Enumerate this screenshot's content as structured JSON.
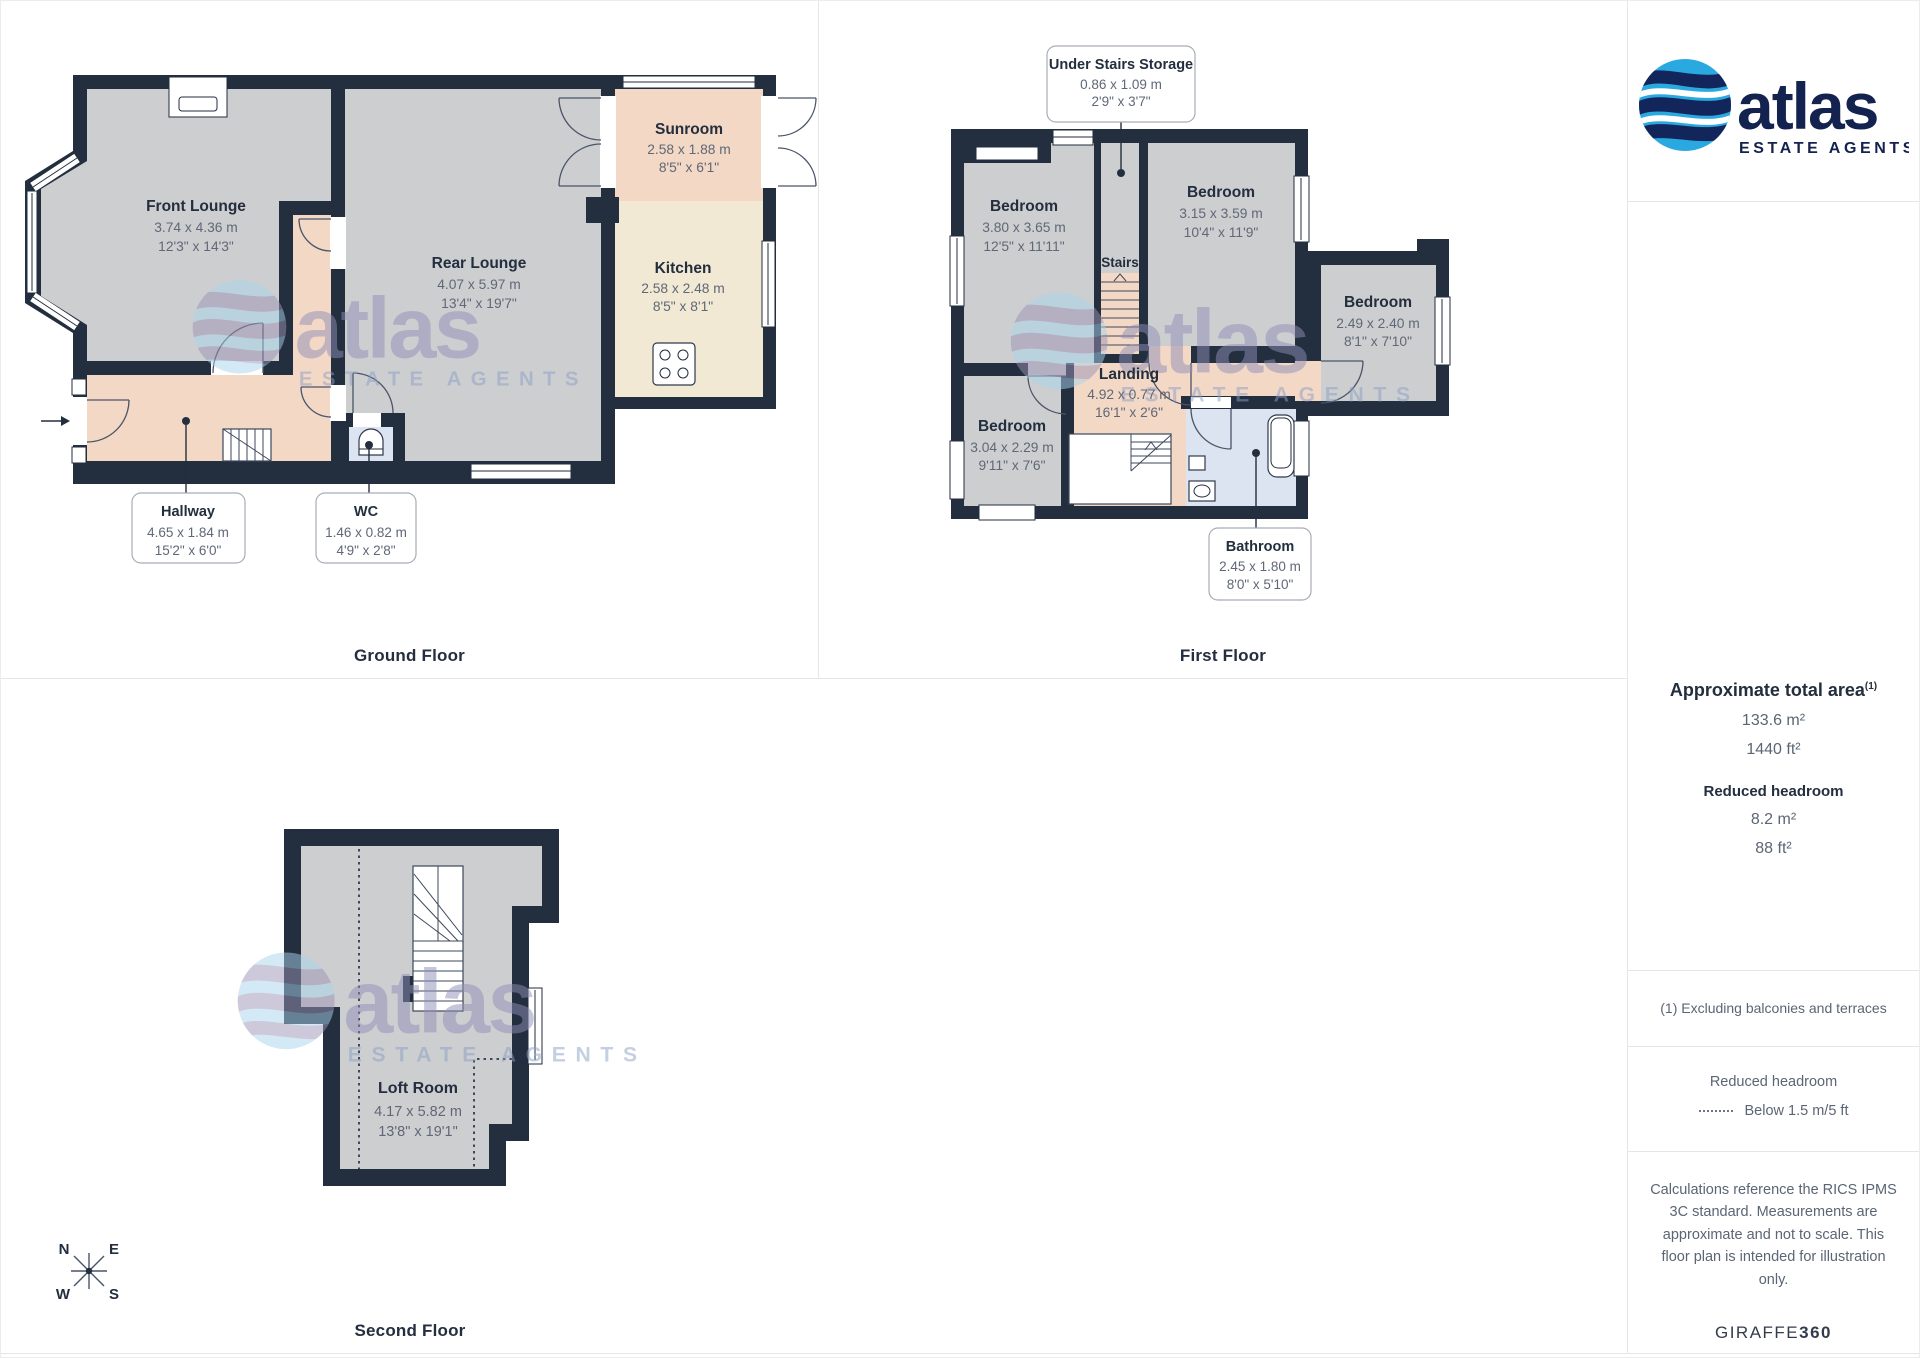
{
  "colors": {
    "wall": "#232e3e",
    "room_gray": "#cdced0",
    "room_peach": "#f3d8c6",
    "room_cream": "#f1e9d4",
    "room_blue": "#dce3f1",
    "panel_border": "#e6e6e6",
    "logo_blue": "#2aa9e0",
    "logo_navy": "#13224e",
    "text_primary": "#232e3e",
    "text_secondary": "#5f6877"
  },
  "branding": {
    "logo_text": "atlas",
    "logo_subtext": "ESTATE AGENTS",
    "watermark_text": "atlas",
    "watermark_subtext": "ESTATE AGENTS",
    "giraffe_regular": "GIRAFFE",
    "giraffe_bold": "360"
  },
  "floors": {
    "ground": {
      "title": "Ground Floor",
      "rooms": {
        "front_lounge": {
          "name": "Front Lounge",
          "metric": "3.74 x 4.36 m",
          "imperial": "12'3\" x 14'3\""
        },
        "rear_lounge": {
          "name": "Rear Lounge",
          "metric": "4.07 x 5.97 m",
          "imperial": "13'4\" x 19'7\""
        },
        "sunroom": {
          "name": "Sunroom",
          "metric": "2.58 x 1.88 m",
          "imperial": "8'5\" x 6'1\""
        },
        "kitchen": {
          "name": "Kitchen",
          "metric": "2.58 x 2.48 m",
          "imperial": "8'5\" x 8'1\""
        }
      },
      "callouts": {
        "hallway": {
          "name": "Hallway",
          "metric": "4.65 x 1.84 m",
          "imperial": "15'2\" x 6'0\""
        },
        "wc": {
          "name": "WC",
          "metric": "1.46 x 0.82 m",
          "imperial": "4'9\" x 2'8\""
        }
      }
    },
    "first": {
      "title": "First Floor",
      "rooms": {
        "bedroom_tl": {
          "name": "Bedroom",
          "metric": "3.80 x 3.65 m",
          "imperial": "12'5\" x 11'11\""
        },
        "bedroom_tr": {
          "name": "Bedroom",
          "metric": "3.15 x 3.59 m",
          "imperial": "10'4\" x 11'9\""
        },
        "bedroom_right": {
          "name": "Bedroom",
          "metric": "2.49 x 2.40 m",
          "imperial": "8'1\" x 7'10\""
        },
        "bedroom_bl": {
          "name": "Bedroom",
          "metric": "3.04 x 2.29 m",
          "imperial": "9'11\" x 7'6\""
        },
        "landing": {
          "name": "Landing",
          "metric": "4.92 x 0.77 m",
          "imperial": "16'1\" x 2'6\""
        },
        "stairs": {
          "name": "Stairs"
        }
      },
      "callouts": {
        "under_stairs": {
          "name": "Under Stairs Storage",
          "metric": "0.86 x 1.09 m",
          "imperial": "2'9\" x 3'7\""
        },
        "bathroom": {
          "name": "Bathroom",
          "metric": "2.45 x 1.80 m",
          "imperial": "8'0\" x 5'10\""
        }
      }
    },
    "second": {
      "title": "Second Floor",
      "rooms": {
        "loft": {
          "name": "Loft Room",
          "metric": "4.17 x 5.82 m",
          "imperial": "13'8\" x 19'1\""
        }
      }
    }
  },
  "sidebar": {
    "total_area_label": "Approximate total area",
    "total_area_sup": "(1)",
    "total_area_m2": "133.6 m²",
    "total_area_ft2": "1440 ft²",
    "reduced_headroom_label": "Reduced headroom",
    "reduced_headroom_m2": "8.2 m²",
    "reduced_headroom_ft2": "88 ft²",
    "footnote": "(1) Excluding balconies and terraces",
    "legend_title": "Reduced headroom",
    "legend_item": "Below 1.5 m/5 ft",
    "disclaimer": "Calculations reference the RICS IPMS 3C standard. Measurements are approximate and not to scale. This floor plan is intended for illustration only."
  },
  "compass": {
    "n": "N",
    "e": "E",
    "w": "W",
    "s": "S"
  }
}
